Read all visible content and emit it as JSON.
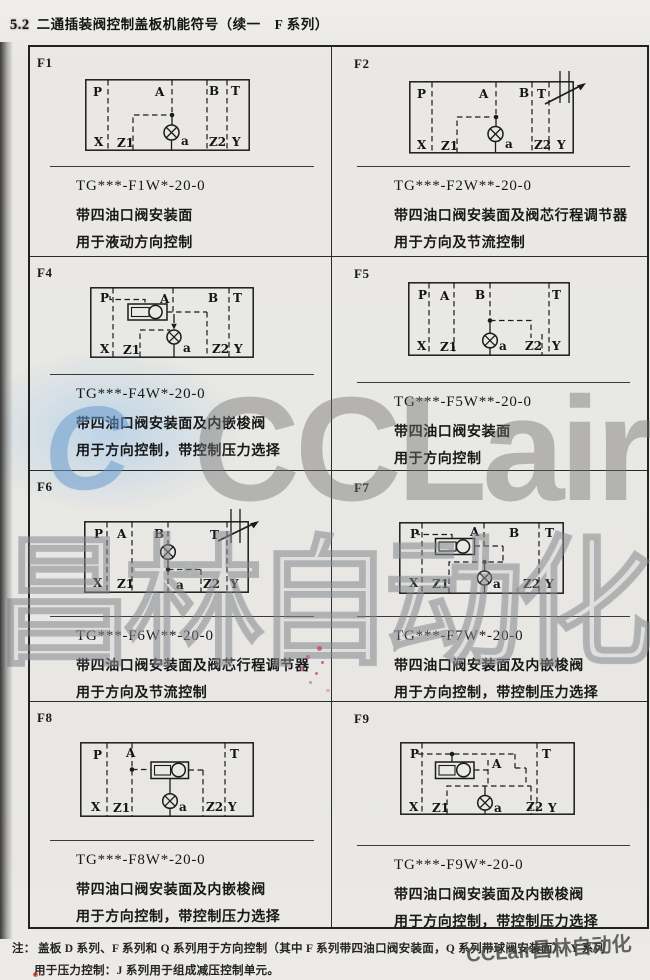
{
  "header": {
    "section": "5.2",
    "title": "二通插装阀控制盖板机能符号（续一　F 系列）"
  },
  "cells": [
    {
      "id": "F1",
      "model": "TG***-F1W*-20-0",
      "desc1": "带四油口阀安装面",
      "desc2": "用于液动方向控制",
      "ports": {
        "p": "P",
        "a": "A",
        "b": "B",
        "t": "T",
        "x": "X",
        "z1": "Z1",
        "pilot": "a",
        "z2": "Z2",
        "y": "Y"
      }
    },
    {
      "id": "F2",
      "model": "TG***-F2W**-20-0",
      "desc1": "带四油口阀安装面及阀芯行程调节器",
      "desc2": "用于方向及节流控制",
      "ports": {
        "p": "P",
        "a": "A",
        "b": "B",
        "t": "T",
        "x": "X",
        "z1": "Z1",
        "pilot": "a",
        "z2": "Z2",
        "y": "Y"
      }
    },
    {
      "id": "F4",
      "model": "TG***-F4W*-20-0",
      "desc1": "带四油口阀安装面及内嵌梭阀",
      "desc2": "用于方向控制，带控制压力选择",
      "ports": {
        "p": "P",
        "a": "A",
        "b": "B",
        "t": "T",
        "x": "X",
        "z1": "Z1",
        "pilot": "a",
        "z2": "Z2",
        "y": "Y"
      }
    },
    {
      "id": "F5",
      "model": "TG***-F5W**-20-0",
      "desc1": "带四油口阀安装面",
      "desc2": "用于方向控制",
      "ports": {
        "p": "P",
        "a": "A",
        "b": "B",
        "t": "T",
        "x": "X",
        "z1": "Z1",
        "pilot": "a",
        "z2": "Z2",
        "y": "Y"
      }
    },
    {
      "id": "F6",
      "model": "TG***-F6W**-20-0",
      "desc1": "带四油口阀安装面及阀芯行程调节器",
      "desc2": "用于方向及节流控制",
      "ports": {
        "p": "P",
        "a": "A",
        "b": "B",
        "t": "T",
        "x": "X",
        "z1": "Z1",
        "pilot": "a",
        "z2": "Z2",
        "y": "Y"
      }
    },
    {
      "id": "F7",
      "model": "TG***-F7W*-20-0",
      "desc1": "带四油口阀安装面及内嵌梭阀",
      "desc2": "用于方向控制，带控制压力选择",
      "ports": {
        "p": "P",
        "a": "A",
        "b": "B",
        "t": "T",
        "x": "X",
        "z1": "Z1",
        "pilot": "a",
        "z2": "Z2",
        "y": "Y"
      }
    },
    {
      "id": "F8",
      "model": "TG***-F8W*-20-0",
      "desc1": "带四油口阀安装面及内嵌梭阀",
      "desc2": "用于方向控制，带控制压力选择",
      "ports": {
        "p": "P",
        "a": "A",
        "t": "T",
        "x": "X",
        "z1": "Z1",
        "pilot": "a",
        "z2": "Z2",
        "y": "Y"
      }
    },
    {
      "id": "F9",
      "model": "TG***-F9W*-20-0",
      "desc1": "带四油口阀安装面及内嵌梭阀",
      "desc2": "用于方向控制，带控制压力选择",
      "ports": {
        "p": "P",
        "a": "A",
        "t": "T",
        "x": "X",
        "z1": "Z1",
        "pilot": "a",
        "z2": "Z2",
        "y": "Y"
      }
    }
  ],
  "footnote": {
    "label": "注：",
    "line1": "盖板 D 系列、F 系列和 Q 系列用于方向控制（其中 F 系列带四油口阀安装面，Q 系列带球阀安装面）、Y 系列",
    "line2": "用于压力控制：J 系列用于组成减压控制单元。"
  },
  "watermark": {
    "logo": "C",
    "brand": "CCLair",
    "brand_cn": "昌林自动化",
    "footer": "CCLair昌林自动化"
  }
}
